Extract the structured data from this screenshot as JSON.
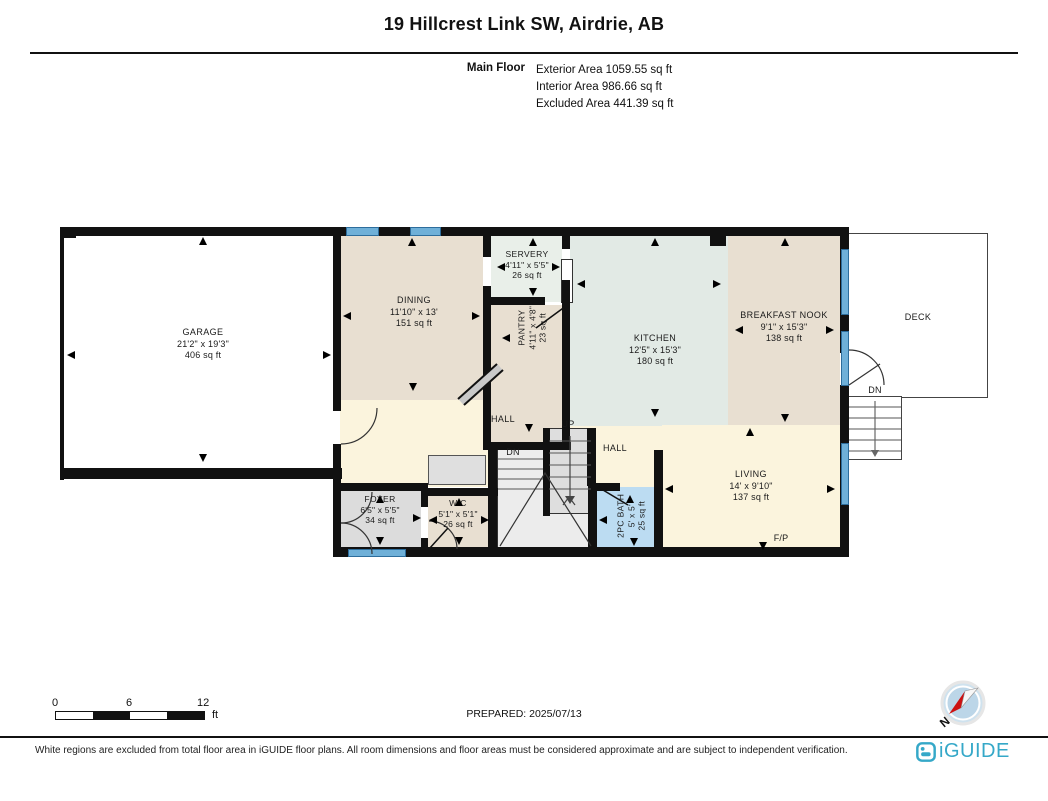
{
  "header": {
    "title": "19 Hillcrest Link SW, Airdrie, AB",
    "floor_label": "Main Floor",
    "stats": {
      "exterior": "Exterior Area 1059.55 sq ft",
      "interior": "Interior Area 986.66 sq ft",
      "excluded": "Excluded Area 441.39 sq ft"
    }
  },
  "rooms": {
    "garage": {
      "name": "GARAGE",
      "dims": "21'2\" x 19'3\"",
      "area": "406 sq ft"
    },
    "dining": {
      "name": "DINING",
      "dims": "11'10\" x 13'",
      "area": "151 sq ft"
    },
    "servery": {
      "name": "SERVERY",
      "dims": "4'11\" x 5'5\"",
      "area": "26 sq ft"
    },
    "pantry": {
      "name": "PANTRY",
      "dims": "4'11\" x 4'8\"",
      "area": "23 sq ft"
    },
    "kitchen": {
      "name": "KITCHEN",
      "dims": "12'5\" x 15'3\"",
      "area": "180 sq ft"
    },
    "breakfast_nook": {
      "name": "BREAKFAST NOOK",
      "dims": "9'1\" x 15'3\"",
      "area": "138 sq ft"
    },
    "deck": {
      "name": "DECK"
    },
    "hall": {
      "name": "HALL"
    },
    "hall2": {
      "name": "HALL"
    },
    "living": {
      "name": "LIVING",
      "dims": "14' x 9'10\"",
      "area": "137 sq ft"
    },
    "foyer": {
      "name": "FOYER",
      "dims": "6'5\" x 5'5\"",
      "area": "34 sq ft"
    },
    "wic": {
      "name": "WIC",
      "dims": "5'1\" x 5'1\"",
      "area": "26 sq ft"
    },
    "bath": {
      "name": "2PC BATH",
      "dims": "5' x 5'",
      "area": "25 sq ft"
    }
  },
  "annotations": {
    "up": "UP",
    "dn": "DN",
    "deck_dn": "DN",
    "fireplace": "F/P",
    "compass_north": "N"
  },
  "scale_bar": {
    "tick0": "0",
    "tick1": "6",
    "tick2": "12",
    "unit": "ft"
  },
  "footer": {
    "prepared": "PREPARED: 2025/07/13",
    "disclaimer": "White regions are excluded from total floor area in iGUIDE floor plans. All room dimensions and floor areas must be considered approximate and are subject to independent verification.",
    "brand": "iGUIDE"
  },
  "colors": {
    "wall": "#111111",
    "window": "#6fb0d8",
    "excluded_white": "#ffffff",
    "tan": "#e8dfd1",
    "kitchen_green": "#e2eae5",
    "servery_green": "#e9efe9",
    "cream": "#fbf4dd",
    "foyer_gray": "#dcdcdc",
    "bath_blue": "#bcdcf2",
    "brand_teal": "#35a8c8"
  }
}
